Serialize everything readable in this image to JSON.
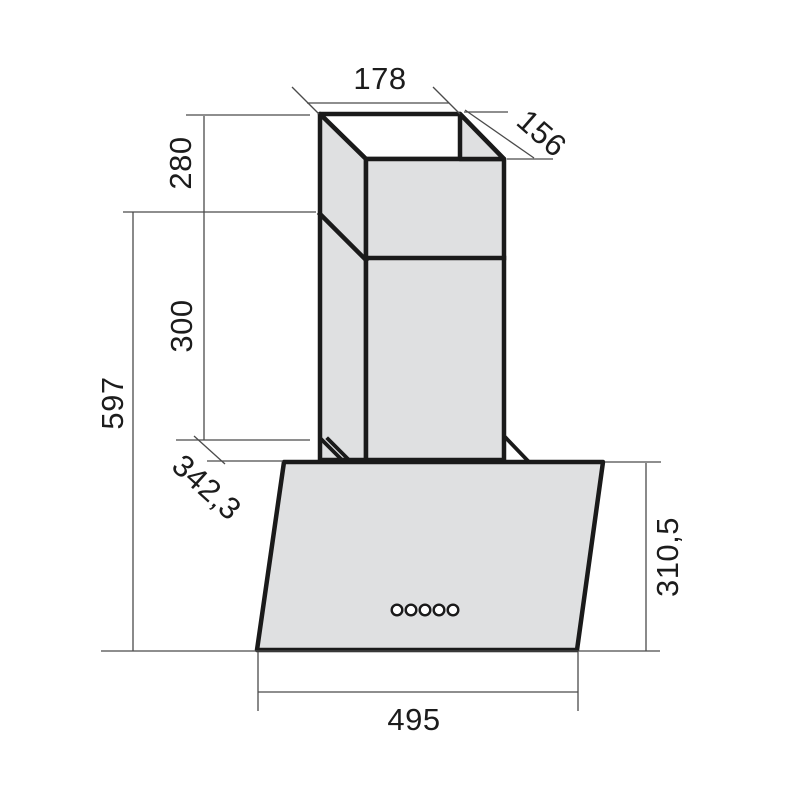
{
  "labels": {
    "chimney_width": "178",
    "chimney_depth": "156",
    "upper_chimney_height": "280",
    "lower_chimney_height": "300",
    "overall_height": "597",
    "body_depth": "342,3",
    "front_panel_height": "310,5",
    "body_width": "495"
  },
  "colors": {
    "background": "#ffffff",
    "panel_fill": "#dfe0e1",
    "outline": "#1a1a1a",
    "dimension_line": "#4b4b4b",
    "label_text": "#1c1c1c"
  },
  "controls": {
    "button_count": 5
  }
}
